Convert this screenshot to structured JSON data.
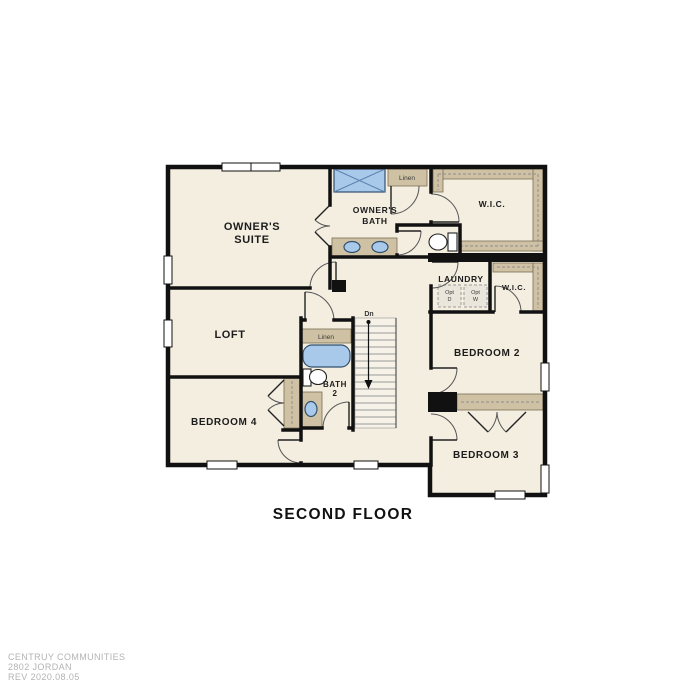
{
  "title": "SECOND FLOOR",
  "footer": {
    "line1": "CENTRUY COMMUNITIES",
    "line2": "2802 JORDAN",
    "line3": "REV 2020.08.05"
  },
  "rooms": {
    "owners_suite": {
      "line1": "OWNER'S",
      "line2": "SUITE"
    },
    "owners_bath": {
      "line1": "OWNER'S",
      "line2": "BATH"
    },
    "wic1": "W.I.C.",
    "laundry": "LAUNDRY",
    "wic2": "W.I.C.",
    "bedroom2": "BEDROOM 2",
    "bedroom3": "BEDROOM 3",
    "loft": "LOFT",
    "bath2": {
      "line1": "BATH",
      "line2": "2"
    },
    "bedroom4": "BEDROOM 4"
  },
  "annotations": {
    "linen_owners_bath": "Linen",
    "linen_bath2": "Linen",
    "stairs_direction": "Dn",
    "opt_dryer": {
      "line1": "Opt",
      "line2": "D"
    },
    "opt_washer": {
      "line1": "Opt",
      "line2": "W"
    }
  },
  "colors": {
    "floor": "#f3eee0",
    "wall": "#111111",
    "cabinet_tan": "#cfc1a4",
    "fixture_blue": "#a9c9ea",
    "fixture_outline": "#33506e",
    "label_text": "#1c1c1c",
    "footer_text": "#b3b3b3",
    "background": "#ffffff"
  }
}
